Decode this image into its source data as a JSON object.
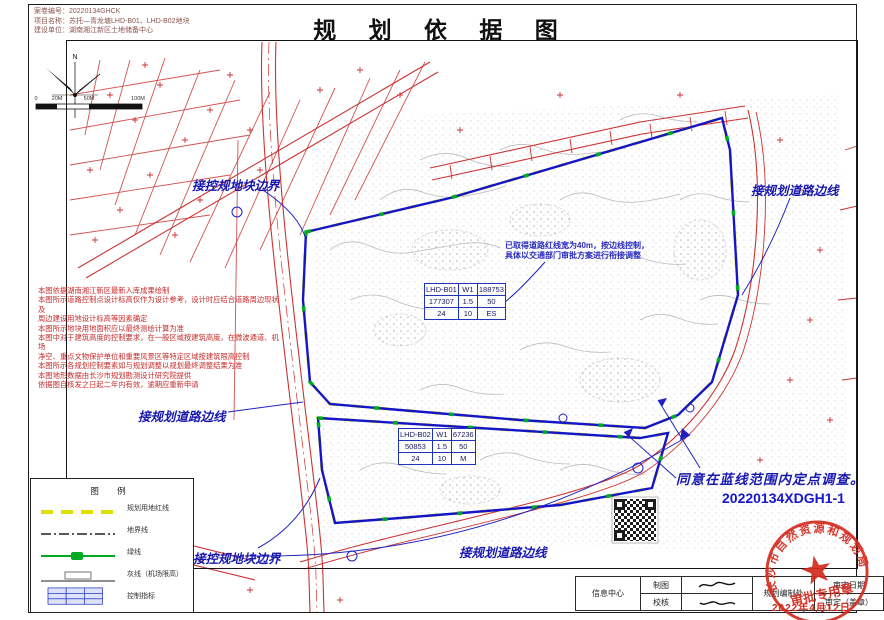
{
  "title": "规 划 依 据 图",
  "header": {
    "sheet_no": "案卷编号：20220134GHCK",
    "project": "项目名称：苏托—青龙塘LHD-B01、LHD-B02地块",
    "owner": "建设单位：湖南湘江新区土地储备中心"
  },
  "notes": {
    "lines": [
      "本图依据湖南湘江新区最新入库成果绘制",
      "本图所示道路控制点设计标高仅作为设计参考，设计时应结合道路周边现状及",
      "周边建设用地设计标高等因素确定",
      "本图所示地块用地面积应以最终测绘计算为准",
      "本图中对于建筑高度的控制要求，在一般区域按建筑高度，在微波通道、机场",
      "净空、重点文物保护单位和重要风景区等特定区域按建筑限高控制",
      "本图所示各规划控制要素如与规划调整以规划最终调整结果为准",
      "本图地形数据由长沙市规划勘测设计研究院提供",
      "依据图自核发之日起二年内有效，逾期应重新申请"
    ]
  },
  "blue_note": {
    "line1": "已取得道路红线宽为40m，按边线控制，",
    "line2": "具体以交通部门审批方案进行衔接调整"
  },
  "annotations": {
    "top_left": "接控规地块边界",
    "right": "接规划道路边线",
    "mid_left": "接规划道路边线",
    "bottom_left": "接控规地块边界",
    "bottom_center": "接规划道路边线",
    "approval_line1": "同意在蓝线范围内定点调查。",
    "approval_line2": "20220134XDGH1-1"
  },
  "tables": {
    "b01": {
      "rows": [
        [
          "LHD-B01",
          "W1",
          "188753"
        ],
        [
          "177307",
          "1.5",
          "50"
        ],
        [
          "24",
          "10",
          "ES"
        ]
      ]
    },
    "b02": {
      "rows": [
        [
          "LHD-B02",
          "W1",
          "67236"
        ],
        [
          "50853",
          "1.5",
          "50"
        ],
        [
          "24",
          "10",
          "M"
        ]
      ]
    }
  },
  "legend": {
    "title": "图 例",
    "items": [
      {
        "label": "规划用地红线"
      },
      {
        "label": "地界线"
      },
      {
        "label": "绿线"
      },
      {
        "label": "灰线（机场限高）"
      },
      {
        "label": "控制指标"
      }
    ]
  },
  "scalebar": {
    "north_label": "N",
    "ticks": [
      "0",
      "20M",
      "50M",
      "100M"
    ]
  },
  "sign_table": {
    "info_center": "信息中心",
    "draw": "制图",
    "check": "校核",
    "dept": "规划编制处",
    "approve_date": "审定日期",
    "approve_seal": "审定（盖章）"
  },
  "stamp": {
    "org": "长沙市自然资源和规划局",
    "type": "审批专用章",
    "no": "（2）",
    "date": "2022年4月12日"
  },
  "colors": {
    "red_line": "#cc3333",
    "blue_line": "#1515c8",
    "green": "#00aa22",
    "yellow": "#e8e83c",
    "annotation_blue": "#1818b0",
    "stamp_red": "#d42a1e",
    "note_red": "#c62a2a"
  }
}
